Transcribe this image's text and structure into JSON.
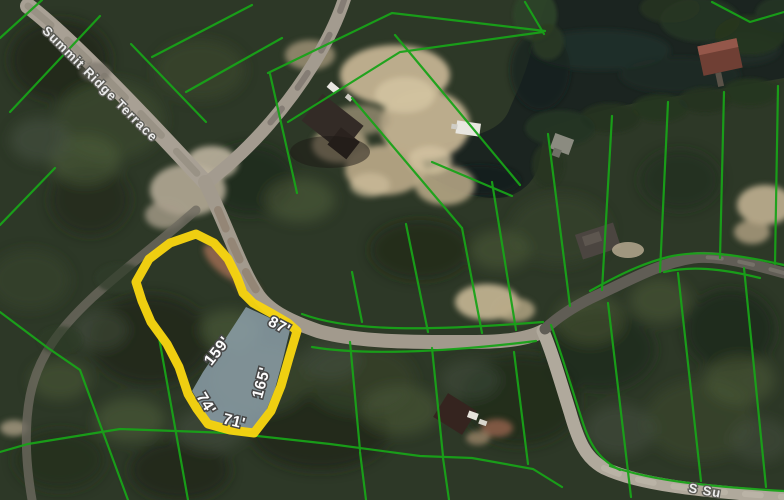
{
  "map": {
    "streets": {
      "main": "Summit Ridge Terrace",
      "partial_bottom_right": "S Su"
    },
    "selected_parcel": {
      "side_lengths": [
        "87'",
        "159'",
        "165'",
        "74'",
        "71'"
      ],
      "highlight_color": "#f6d411",
      "fill_color": "#94a6b4"
    },
    "layers": {
      "parcel_line_color": "#19a319",
      "water_color": "#1b2420"
    }
  }
}
